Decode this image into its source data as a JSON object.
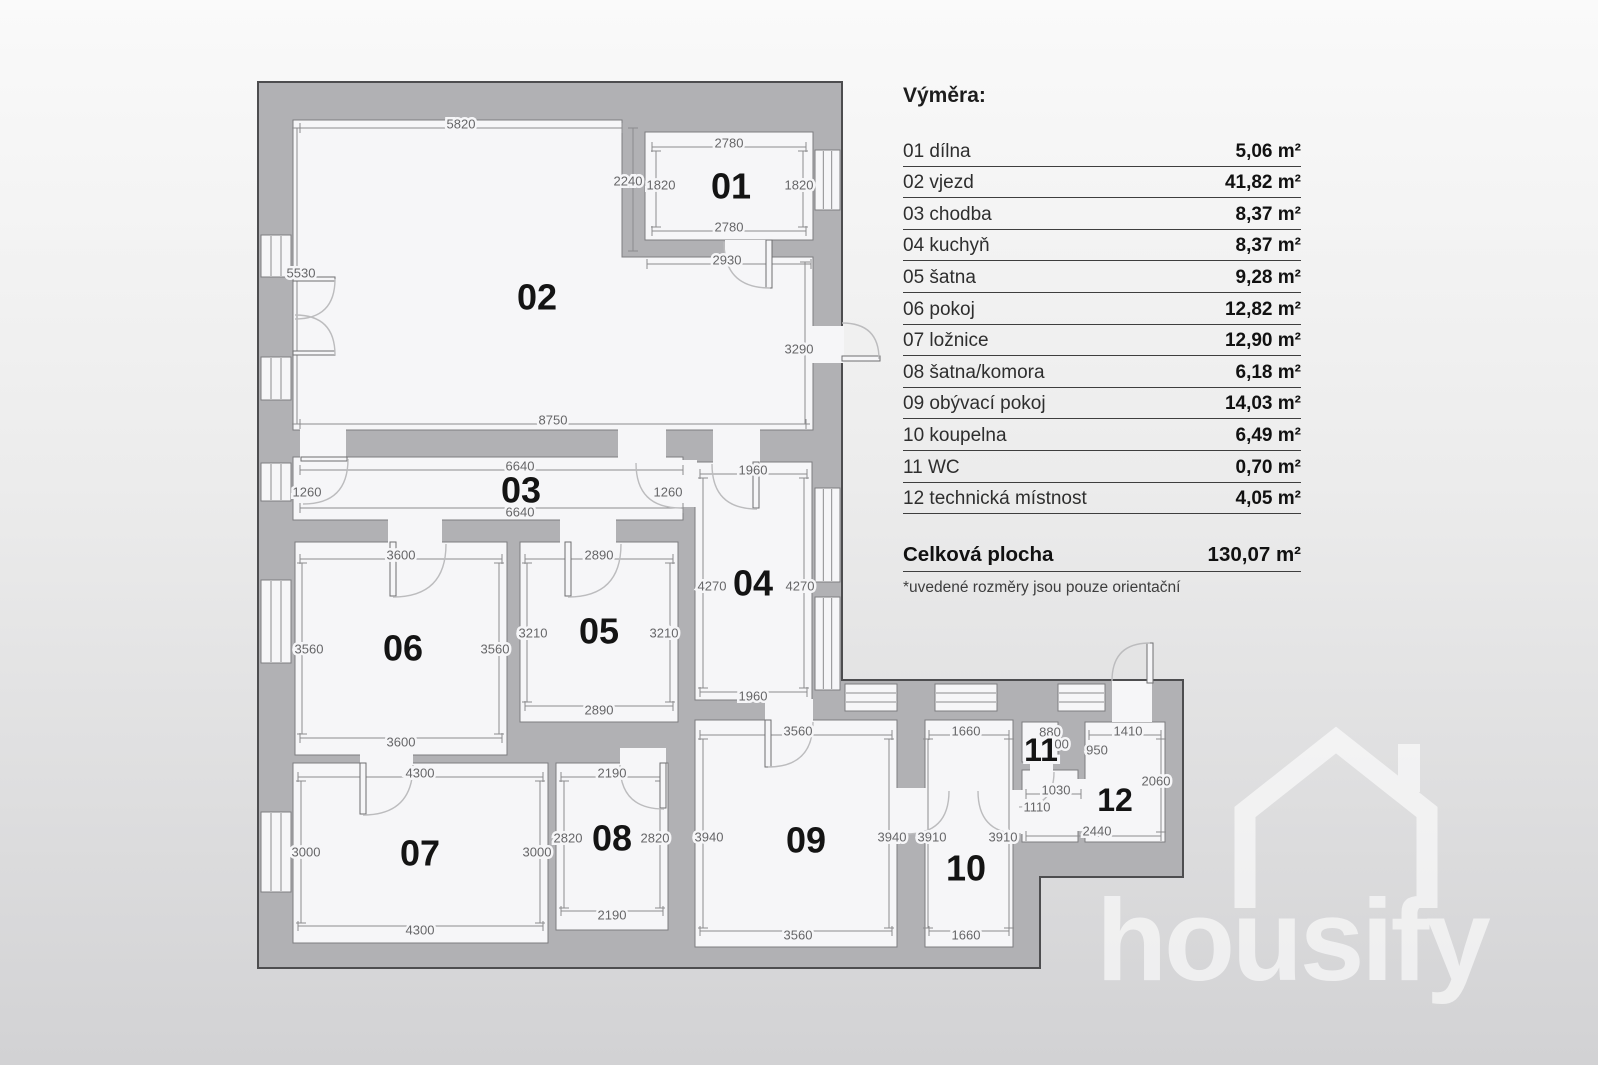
{
  "legend": {
    "title": "Výměra:",
    "rows": [
      {
        "name": "01 dílna",
        "area": "5,06 m²"
      },
      {
        "name": "02 vjezd",
        "area": "41,82 m²"
      },
      {
        "name": "03 chodba",
        "area": "8,37 m²"
      },
      {
        "name": "04 kuchyň",
        "area": "8,37 m²"
      },
      {
        "name": "05 šatna",
        "area": "9,28 m²"
      },
      {
        "name": "06 pokoj",
        "area": "12,82 m²"
      },
      {
        "name": "07 ložnice",
        "area": "12,90 m²"
      },
      {
        "name": "08 šatna/komora",
        "area": "6,18 m²"
      },
      {
        "name": "09 obývací pokoj",
        "area": "14,03 m²"
      },
      {
        "name": "10 koupelna",
        "area": "6,49 m²"
      },
      {
        "name": "11 WC",
        "area": "0,70 m²"
      },
      {
        "name": "12 technická místnost",
        "area": "4,05 m²"
      }
    ],
    "total_label": "Celková plocha",
    "total_value": "130,07 m²",
    "note": "*uvedené rozměry jsou pouze orientační"
  },
  "watermark": {
    "brand": "housify"
  },
  "colors": {
    "wall": "#b1b1b4",
    "wall_edge": "#4d4d4f",
    "floor": "#f6f6f8",
    "room_edge": "#7d7d80",
    "dim_line": "#8c8c8e",
    "dim_text": "#666668",
    "arc": "#bcbcbe",
    "leaf_edge": "#6f6f71",
    "room_num": "#141414"
  },
  "plan": {
    "outline": "M258 82 H842 V680 H1183 V877 H1040 V968 H258 Z",
    "rooms": [
      {
        "num": "01",
        "nx": 731,
        "ny": 186,
        "rect": [
          645,
          132,
          168,
          108
        ]
      },
      {
        "num": "02",
        "nx": 537,
        "ny": 297,
        "pts": [
          [
            293,
            120
          ],
          [
            622,
            120
          ],
          [
            622,
            257
          ],
          [
            813,
            257
          ],
          [
            813,
            430
          ],
          [
            293,
            430
          ]
        ]
      },
      {
        "num": "03",
        "nx": 521,
        "ny": 490,
        "rect": [
          293,
          457,
          390,
          63
        ]
      },
      {
        "num": "04",
        "nx": 753,
        "ny": 583,
        "rect": [
          695,
          462,
          117,
          238
        ]
      },
      {
        "num": "05",
        "nx": 599,
        "ny": 631,
        "rect": [
          520,
          542,
          158,
          180
        ]
      },
      {
        "num": "06",
        "nx": 403,
        "ny": 648,
        "rect": [
          295,
          542,
          212,
          213
        ]
      },
      {
        "num": "07",
        "nx": 420,
        "ny": 853,
        "rect": [
          293,
          763,
          255,
          180
        ]
      },
      {
        "num": "08",
        "nx": 612,
        "ny": 838,
        "rect": [
          556,
          763,
          112,
          167
        ]
      },
      {
        "num": "09",
        "nx": 806,
        "ny": 840,
        "rect": [
          695,
          720,
          202,
          227
        ]
      },
      {
        "num": "10",
        "nx": 966,
        "ny": 868,
        "rect": [
          925,
          720,
          88,
          227
        ]
      },
      {
        "num": "11",
        "nx": 1041,
        "ny": 750,
        "s": 32,
        "rect": [
          1022,
          722,
          36,
          40
        ]
      },
      {
        "num": "12",
        "nx": 1115,
        "ny": 800,
        "s": 32,
        "rect": [
          1085,
          722,
          80,
          120
        ]
      },
      {
        "num": "",
        "nx": 0,
        "ny": 0,
        "rect": [
          1022,
          770,
          56,
          72
        ]
      }
    ],
    "windows": [
      [
        261,
        235,
        30,
        42
      ],
      [
        261,
        357,
        30,
        43
      ],
      [
        261,
        463,
        30,
        38
      ],
      [
        261,
        580,
        30,
        83
      ],
      [
        261,
        812,
        30,
        80
      ],
      [
        815,
        150,
        25,
        60
      ],
      [
        815,
        488,
        25,
        94
      ],
      [
        815,
        597,
        25,
        93
      ],
      [
        845,
        684,
        52,
        27
      ],
      [
        935,
        684,
        62,
        27
      ],
      [
        1058,
        684,
        47,
        27
      ]
    ],
    "gaps": [
      [
        725,
        240,
        42,
        19
      ],
      [
        300,
        428,
        46,
        32
      ],
      [
        618,
        428,
        48,
        33
      ],
      [
        713,
        428,
        47,
        36
      ],
      [
        388,
        518,
        54,
        26
      ],
      [
        560,
        518,
        56,
        26
      ],
      [
        678,
        460,
        19,
        47
      ],
      [
        360,
        752,
        53,
        13
      ],
      [
        620,
        748,
        46,
        17
      ],
      [
        765,
        699,
        48,
        23
      ],
      [
        895,
        788,
        32,
        46
      ],
      [
        1011,
        790,
        13,
        44
      ],
      [
        1030,
        760,
        23,
        12
      ],
      [
        1076,
        779,
        11,
        52
      ],
      [
        1112,
        681,
        40,
        41
      ],
      [
        811,
        326,
        33,
        37
      ]
    ],
    "doors": [
      {
        "c": [
          770,
          242
        ],
        "a": [
          724,
          242
        ],
        "b": [
          770,
          288
        ],
        "leaf": [
          766,
          240,
          6,
          48
        ]
      },
      {
        "c": [
          295,
          279
        ],
        "a": [
          335,
          279
        ],
        "b": [
          295,
          319
        ],
        "leaf": [
          293,
          277,
          42,
          4
        ]
      },
      {
        "c": [
          295,
          355
        ],
        "a": [
          335,
          355
        ],
        "b": [
          295,
          315
        ],
        "leaf": [
          293,
          351,
          42,
          4
        ]
      },
      {
        "c": [
          303,
          459
        ],
        "a": [
          348,
          459
        ],
        "b": [
          303,
          504
        ],
        "leaf": [
          301,
          457,
          46,
          4
        ]
      },
      {
        "c": [
          757,
          464
        ],
        "a": [
          712,
          464
        ],
        "b": [
          757,
          509
        ],
        "leaf": [
          753,
          462,
          6,
          46
        ]
      },
      {
        "c": [
          681,
          463
        ],
        "a": [
          636,
          463
        ],
        "b": [
          681,
          508
        ]
      },
      {
        "c": [
          393,
          544
        ],
        "a": [
          446,
          544
        ],
        "b": [
          393,
          597
        ],
        "leaf": [
          390,
          542,
          6,
          54
        ]
      },
      {
        "c": [
          568,
          544
        ],
        "a": [
          621,
          544
        ],
        "b": [
          568,
          597
        ],
        "leaf": [
          565,
          542,
          6,
          54
        ]
      },
      {
        "c": [
          363,
          765
        ],
        "a": [
          413,
          765
        ],
        "b": [
          363,
          815
        ],
        "leaf": [
          360,
          763,
          6,
          51
        ]
      },
      {
        "c": [
          664,
          765
        ],
        "a": [
          620,
          765
        ],
        "b": [
          664,
          809
        ],
        "leaf": [
          660,
          763,
          6,
          45
        ]
      },
      {
        "c": [
          768,
          722
        ],
        "a": [
          813,
          722
        ],
        "b": [
          768,
          767
        ],
        "leaf": [
          765,
          720,
          6,
          47
        ]
      },
      {
        "c": [
          906,
          791
        ],
        "a": [
          906,
          834
        ],
        "b": [
          949,
          791
        ]
      },
      {
        "c": [
          1021,
          791
        ],
        "a": [
          1021,
          834
        ],
        "b": [
          978,
          791
        ]
      },
      {
        "c": [
          1019,
          772
        ],
        "a": [
          1054,
          772
        ],
        "b": [
          1019,
          807
        ]
      },
      {
        "c": [
          1150,
          681
        ],
        "a": [
          1112,
          681
        ],
        "b": [
          1150,
          643
        ],
        "leaf": [
          1147,
          643,
          6,
          40
        ]
      },
      {
        "c": [
          842,
          359
        ],
        "a": [
          842,
          323
        ],
        "b": [
          879,
          359
        ],
        "leaf": [
          842,
          356,
          38,
          5
        ]
      }
    ],
    "dims": [
      {
        "t": "5820",
        "x": 461,
        "y": 124,
        "l": [
          300,
          128,
          622,
          128
        ]
      },
      {
        "t": "2780",
        "x": 729,
        "y": 143,
        "l": [
          652,
          147,
          806,
          147
        ]
      },
      {
        "t": "1820",
        "x": 661,
        "y": 185,
        "l": [
          656,
          151,
          656,
          227
        ]
      },
      {
        "t": "1820",
        "x": 799,
        "y": 185,
        "l": [
          803,
          151,
          803,
          227
        ]
      },
      {
        "t": "2780",
        "x": 729,
        "y": 227,
        "l": [
          652,
          231,
          806,
          231
        ]
      },
      {
        "t": "2240",
        "x": 628,
        "y": 181,
        "l": [
          633,
          128,
          633,
          251
        ]
      },
      {
        "t": "2930",
        "x": 727,
        "y": 260,
        "l": [
          647,
          264,
          811,
          264
        ]
      },
      {
        "t": "5530",
        "x": 301,
        "y": 273,
        "l": [
          297,
          128,
          297,
          424
        ]
      },
      {
        "t": "3290",
        "x": 799,
        "y": 349,
        "l": [
          805,
          262,
          805,
          424
        ]
      },
      {
        "t": "8750",
        "x": 553,
        "y": 420,
        "l": [
          300,
          424,
          806,
          424
        ]
      },
      {
        "t": "6640",
        "x": 520,
        "y": 466,
        "l": [
          300,
          470,
          683,
          470
        ]
      },
      {
        "t": "1260",
        "x": 307,
        "y": 492
      },
      {
        "t": "1260",
        "x": 668,
        "y": 492
      },
      {
        "t": "6640",
        "x": 520,
        "y": 512,
        "l": [
          300,
          508,
          683,
          508
        ]
      },
      {
        "t": "1960",
        "x": 753,
        "y": 470,
        "l": [
          700,
          474,
          807,
          474
        ]
      },
      {
        "t": "4270",
        "x": 712,
        "y": 586,
        "l": [
          703,
          478,
          703,
          688
        ]
      },
      {
        "t": "4270",
        "x": 800,
        "y": 586,
        "l": [
          804,
          478,
          804,
          688
        ]
      },
      {
        "t": "1960",
        "x": 753,
        "y": 696,
        "l": [
          700,
          692,
          807,
          692
        ]
      },
      {
        "t": "3600",
        "x": 401,
        "y": 555,
        "l": [
          300,
          559,
          502,
          559
        ]
      },
      {
        "t": "3560",
        "x": 309,
        "y": 649,
        "l": [
          302,
          563,
          302,
          734
        ]
      },
      {
        "t": "3560",
        "x": 495,
        "y": 649,
        "l": [
          499,
          563,
          499,
          734
        ]
      },
      {
        "t": "3600",
        "x": 401,
        "y": 742,
        "l": [
          300,
          738,
          502,
          738
        ]
      },
      {
        "t": "2890",
        "x": 599,
        "y": 555,
        "l": [
          525,
          559,
          673,
          559
        ]
      },
      {
        "t": "3210",
        "x": 533,
        "y": 633,
        "l": [
          527,
          563,
          527,
          702
        ]
      },
      {
        "t": "3210",
        "x": 664,
        "y": 633,
        "l": [
          670,
          563,
          670,
          702
        ]
      },
      {
        "t": "2890",
        "x": 599,
        "y": 710,
        "l": [
          525,
          706,
          673,
          706
        ]
      },
      {
        "t": "4300",
        "x": 420,
        "y": 773,
        "l": [
          298,
          777,
          543,
          777
        ]
      },
      {
        "t": "3000",
        "x": 306,
        "y": 852,
        "l": [
          301,
          781,
          301,
          923
        ]
      },
      {
        "t": "3000",
        "x": 537,
        "y": 852,
        "l": [
          540,
          781,
          540,
          923
        ]
      },
      {
        "t": "4300",
        "x": 420,
        "y": 930,
        "l": [
          298,
          926,
          543,
          926
        ]
      },
      {
        "t": "2190",
        "x": 612,
        "y": 773,
        "l": [
          561,
          777,
          663,
          777
        ]
      },
      {
        "t": "2820",
        "x": 568,
        "y": 838,
        "l": [
          564,
          781,
          564,
          908
        ]
      },
      {
        "t": "2820",
        "x": 655,
        "y": 838,
        "l": [
          660,
          781,
          660,
          908
        ]
      },
      {
        "t": "2190",
        "x": 612,
        "y": 915,
        "l": [
          561,
          911,
          663,
          911
        ]
      },
      {
        "t": "3560",
        "x": 798,
        "y": 731,
        "l": [
          700,
          735,
          892,
          735
        ]
      },
      {
        "t": "3940",
        "x": 709,
        "y": 837,
        "l": [
          703,
          739,
          703,
          928
        ]
      },
      {
        "t": "3940",
        "x": 892,
        "y": 837,
        "l": [
          889,
          739,
          889,
          928
        ]
      },
      {
        "t": "3560",
        "x": 798,
        "y": 935,
        "l": [
          700,
          931,
          892,
          931
        ]
      },
      {
        "t": "1660",
        "x": 966,
        "y": 731,
        "l": [
          929,
          735,
          1009,
          735
        ]
      },
      {
        "t": "3910",
        "x": 932,
        "y": 837,
        "l": [
          928,
          739,
          928,
          928
        ]
      },
      {
        "t": "3910",
        "x": 1003,
        "y": 837,
        "l": [
          1009,
          739,
          1009,
          928
        ]
      },
      {
        "t": "1660",
        "x": 966,
        "y": 935,
        "l": [
          929,
          931,
          1009,
          931
        ]
      },
      {
        "t": "880",
        "x": 1050,
        "y": 732
      },
      {
        "t": "800",
        "x": 1058,
        "y": 744
      },
      {
        "t": "1410",
        "x": 1128,
        "y": 731,
        "l": [
          1089,
          735,
          1161,
          735
        ]
      },
      {
        "t": "950",
        "x": 1097,
        "y": 750
      },
      {
        "t": "2060",
        "x": 1156,
        "y": 781,
        "l": [
          1161,
          739,
          1161,
          832
        ]
      },
      {
        "t": "1030",
        "x": 1056,
        "y": 790,
        "l": [
          1026,
          794,
          1081,
          794
        ]
      },
      {
        "t": "1110",
        "x": 1037,
        "y": 807
      },
      {
        "t": "2440",
        "x": 1097,
        "y": 831,
        "l": [
          1026,
          836,
          1161,
          836
        ]
      }
    ]
  }
}
